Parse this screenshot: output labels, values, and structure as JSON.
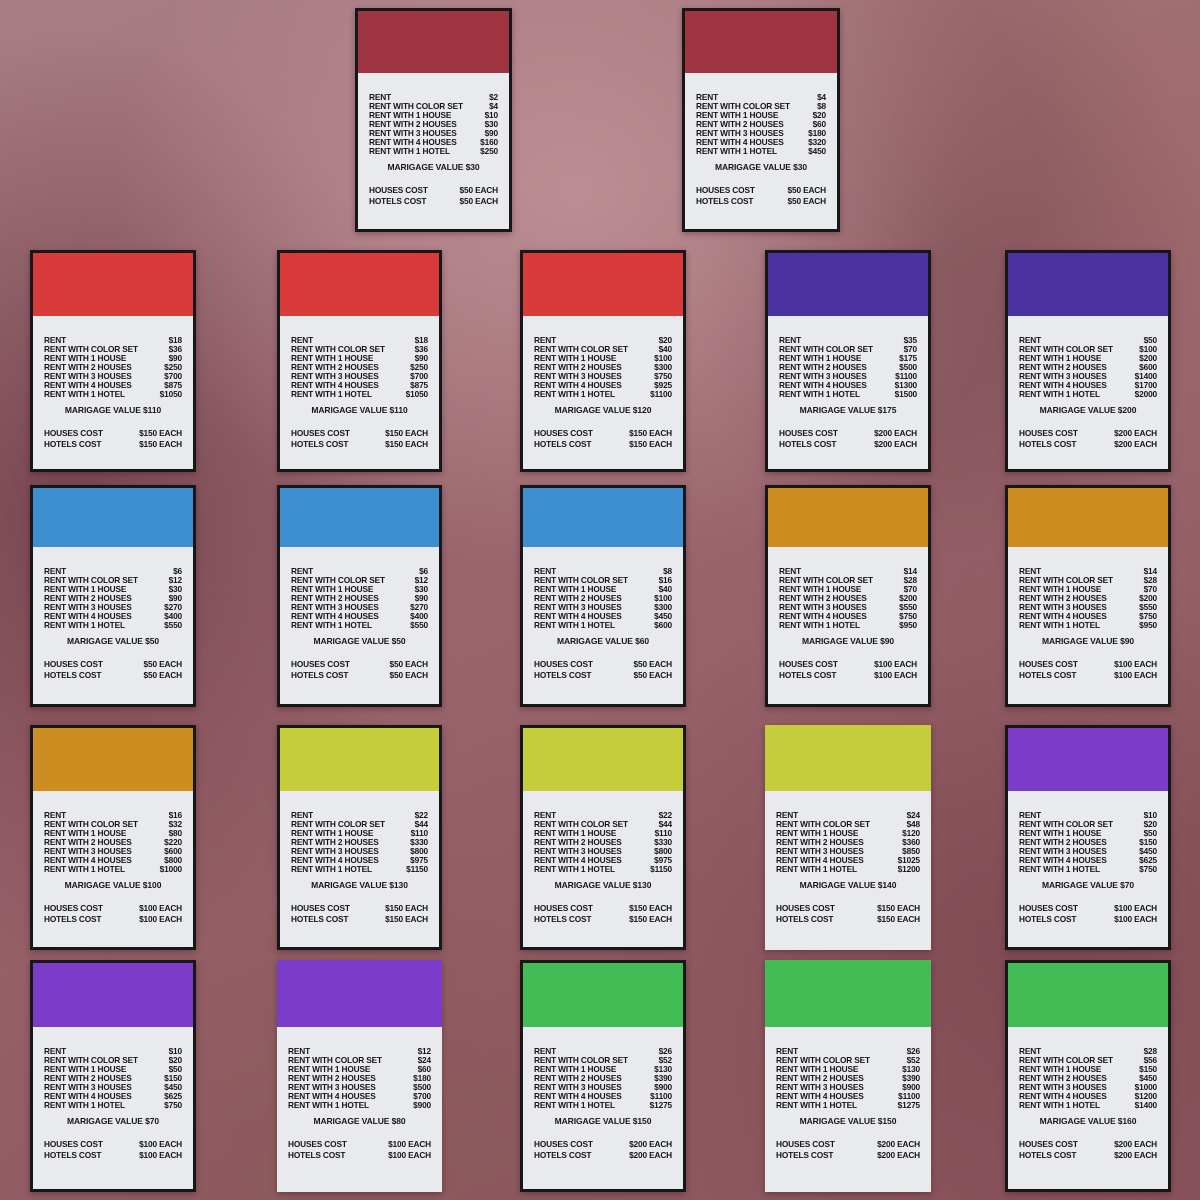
{
  "card_labels": {
    "rent_rows": [
      "RENT",
      "RENT WITH COLOR SET",
      "RENT WITH 1 HOUSE",
      "RENT WITH 2 HOUSES",
      "RENT WITH 3 HOUSES",
      "RENT WITH 4 HOUSES",
      "RENT WITH 1 HOTEL"
    ],
    "houses_cost_label": "HOUSES COST",
    "hotels_cost_label": "HOTELS COST"
  },
  "colors": {
    "maroon": "#9E3540",
    "red": "#D93A3A",
    "indigo": "#4C31A0",
    "blue": "#3E8FD0",
    "orange": "#CD8D20",
    "yellow": "#C5CD3B",
    "purple": "#7B3DC9",
    "green": "#42BD56",
    "card_body": "#E9EAEE",
    "card_frame": "#17171A"
  },
  "cards": [
    {
      "row": 0,
      "col": 0,
      "color": "maroon",
      "framed": true,
      "rents": [
        "$2",
        "$4",
        "$10",
        "$30",
        "$90",
        "$160",
        "$250"
      ],
      "marigage": "MARIGAGE VALUE $30",
      "houses_cost": "$50 EACH",
      "hotels_cost": "$50 EACH"
    },
    {
      "row": 0,
      "col": 1,
      "color": "maroon",
      "framed": true,
      "rents": [
        "$4",
        "$8",
        "$20",
        "$60",
        "$180",
        "$320",
        "$450"
      ],
      "marigage": "MARIGAGE VALUE $30",
      "houses_cost": "$50 EACH",
      "hotels_cost": "$50 EACH"
    },
    {
      "row": 1,
      "col": 0,
      "color": "red",
      "framed": true,
      "rents": [
        "$18",
        "$36",
        "$90",
        "$250",
        "$700",
        "$875",
        "$1050"
      ],
      "marigage": "MARIGAGE VALUE $110",
      "houses_cost": "$150 EACH",
      "hotels_cost": "$150 EACH"
    },
    {
      "row": 1,
      "col": 1,
      "color": "red",
      "framed": true,
      "rents": [
        "$18",
        "$36",
        "$90",
        "$250",
        "$700",
        "$875",
        "$1050"
      ],
      "marigage": "MARIGAGE VALUE $110",
      "houses_cost": "$150 EACH",
      "hotels_cost": "$150 EACH"
    },
    {
      "row": 1,
      "col": 2,
      "color": "red",
      "framed": true,
      "rents": [
        "$20",
        "$40",
        "$100",
        "$300",
        "$750",
        "$925",
        "$1100"
      ],
      "marigage": "MARIGAGE VALUE $120",
      "houses_cost": "$150 EACH",
      "hotels_cost": "$150 EACH"
    },
    {
      "row": 1,
      "col": 3,
      "color": "indigo",
      "framed": true,
      "rents": [
        "$35",
        "$70",
        "$175",
        "$500",
        "$1100",
        "$1300",
        "$1500"
      ],
      "marigage": "MARIGAGE VALUE $175",
      "houses_cost": "$200 EACH",
      "hotels_cost": "$200 EACH"
    },
    {
      "row": 1,
      "col": 4,
      "color": "indigo",
      "framed": true,
      "rents": [
        "$50",
        "$100",
        "$200",
        "$600",
        "$1400",
        "$1700",
        "$2000"
      ],
      "marigage": "MARIGAGE VALUE $200",
      "houses_cost": "$200 EACH",
      "hotels_cost": "$200 EACH"
    },
    {
      "row": 2,
      "col": 0,
      "color": "blue",
      "framed": true,
      "rents": [
        "$6",
        "$12",
        "$30",
        "$90",
        "$270",
        "$400",
        "$550"
      ],
      "marigage": "MARIGAGE VALUE $50",
      "houses_cost": "$50 EACH",
      "hotels_cost": "$50 EACH"
    },
    {
      "row": 2,
      "col": 1,
      "color": "blue",
      "framed": true,
      "rents": [
        "$6",
        "$12",
        "$30",
        "$90",
        "$270",
        "$400",
        "$550"
      ],
      "marigage": "MARIGAGE VALUE $50",
      "houses_cost": "$50 EACH",
      "hotels_cost": "$50 EACH"
    },
    {
      "row": 2,
      "col": 2,
      "color": "blue",
      "framed": true,
      "rents": [
        "$8",
        "$16",
        "$40",
        "$100",
        "$300",
        "$450",
        "$600"
      ],
      "marigage": "MARIGAGE VALUE $60",
      "houses_cost": "$50 EACH",
      "hotels_cost": "$50 EACH"
    },
    {
      "row": 2,
      "col": 3,
      "color": "orange",
      "framed": true,
      "rents": [
        "$14",
        "$28",
        "$70",
        "$200",
        "$550",
        "$750",
        "$950"
      ],
      "marigage": "MARIGAGE VALUE $90",
      "houses_cost": "$100 EACH",
      "hotels_cost": "$100 EACH"
    },
    {
      "row": 2,
      "col": 4,
      "color": "orange",
      "framed": true,
      "rents": [
        "$14",
        "$28",
        "$70",
        "$200",
        "$550",
        "$750",
        "$950"
      ],
      "marigage": "MARIGAGE VALUE $90",
      "houses_cost": "$100 EACH",
      "hotels_cost": "$100 EACH"
    },
    {
      "row": 3,
      "col": 0,
      "color": "orange",
      "framed": true,
      "rents": [
        "$16",
        "$32",
        "$80",
        "$220",
        "$600",
        "$800",
        "$1000"
      ],
      "marigage": "MARIGAGE VALUE $100",
      "houses_cost": "$100 EACH",
      "hotels_cost": "$100 EACH"
    },
    {
      "row": 3,
      "col": 1,
      "color": "yellow",
      "framed": true,
      "rents": [
        "$22",
        "$44",
        "$110",
        "$330",
        "$800",
        "$975",
        "$1150"
      ],
      "marigage": "MARIGAGE VALUE $130",
      "houses_cost": "$150 EACH",
      "hotels_cost": "$150 EACH"
    },
    {
      "row": 3,
      "col": 2,
      "color": "yellow",
      "framed": true,
      "rents": [
        "$22",
        "$44",
        "$110",
        "$330",
        "$800",
        "$975",
        "$1150"
      ],
      "marigage": "MARIGAGE VALUE $130",
      "houses_cost": "$150 EACH",
      "hotels_cost": "$150 EACH"
    },
    {
      "row": 3,
      "col": 3,
      "color": "yellow",
      "framed": false,
      "rents": [
        "$24",
        "$48",
        "$120",
        "$360",
        "$850",
        "$1025",
        "$1200"
      ],
      "marigage": "MARIGAGE VALUE $140",
      "houses_cost": "$150 EACH",
      "hotels_cost": "$150 EACH"
    },
    {
      "row": 3,
      "col": 4,
      "color": "purple",
      "framed": true,
      "rents": [
        "$10",
        "$20",
        "$50",
        "$150",
        "$450",
        "$625",
        "$750"
      ],
      "marigage": "MARIGAGE VALUE $70",
      "houses_cost": "$100 EACH",
      "hotels_cost": "$100 EACH"
    },
    {
      "row": 4,
      "col": 0,
      "color": "purple",
      "framed": true,
      "rents": [
        "$10",
        "$20",
        "$50",
        "$150",
        "$450",
        "$625",
        "$750"
      ],
      "marigage": "MARIGAGE VALUE $70",
      "houses_cost": "$100 EACH",
      "hotels_cost": "$100 EACH"
    },
    {
      "row": 4,
      "col": 1,
      "color": "purple",
      "framed": false,
      "rents": [
        "$12",
        "$24",
        "$60",
        "$180",
        "$500",
        "$700",
        "$900"
      ],
      "marigage": "MARIGAGE VALUE $80",
      "houses_cost": "$100 EACH",
      "hotels_cost": "$100 EACH"
    },
    {
      "row": 4,
      "col": 2,
      "color": "green",
      "framed": true,
      "rents": [
        "$26",
        "$52",
        "$130",
        "$390",
        "$900",
        "$1100",
        "$1275"
      ],
      "marigage": "MARIGAGE VALUE $150",
      "houses_cost": "$200 EACH",
      "hotels_cost": "$200 EACH"
    },
    {
      "row": 4,
      "col": 3,
      "color": "green",
      "framed": false,
      "rents": [
        "$26",
        "$52",
        "$130",
        "$390",
        "$900",
        "$1100",
        "$1275"
      ],
      "marigage": "MARIGAGE VALUE $150",
      "houses_cost": "$200 EACH",
      "hotels_cost": "$200 EACH"
    },
    {
      "row": 4,
      "col": 4,
      "color": "green",
      "framed": true,
      "rents": [
        "$28",
        "$56",
        "$150",
        "$450",
        "$1000",
        "$1200",
        "$1400"
      ],
      "marigage": "MARIGAGE VALUE $160",
      "houses_cost": "$200 EACH",
      "hotels_cost": "$200 EACH"
    }
  ]
}
